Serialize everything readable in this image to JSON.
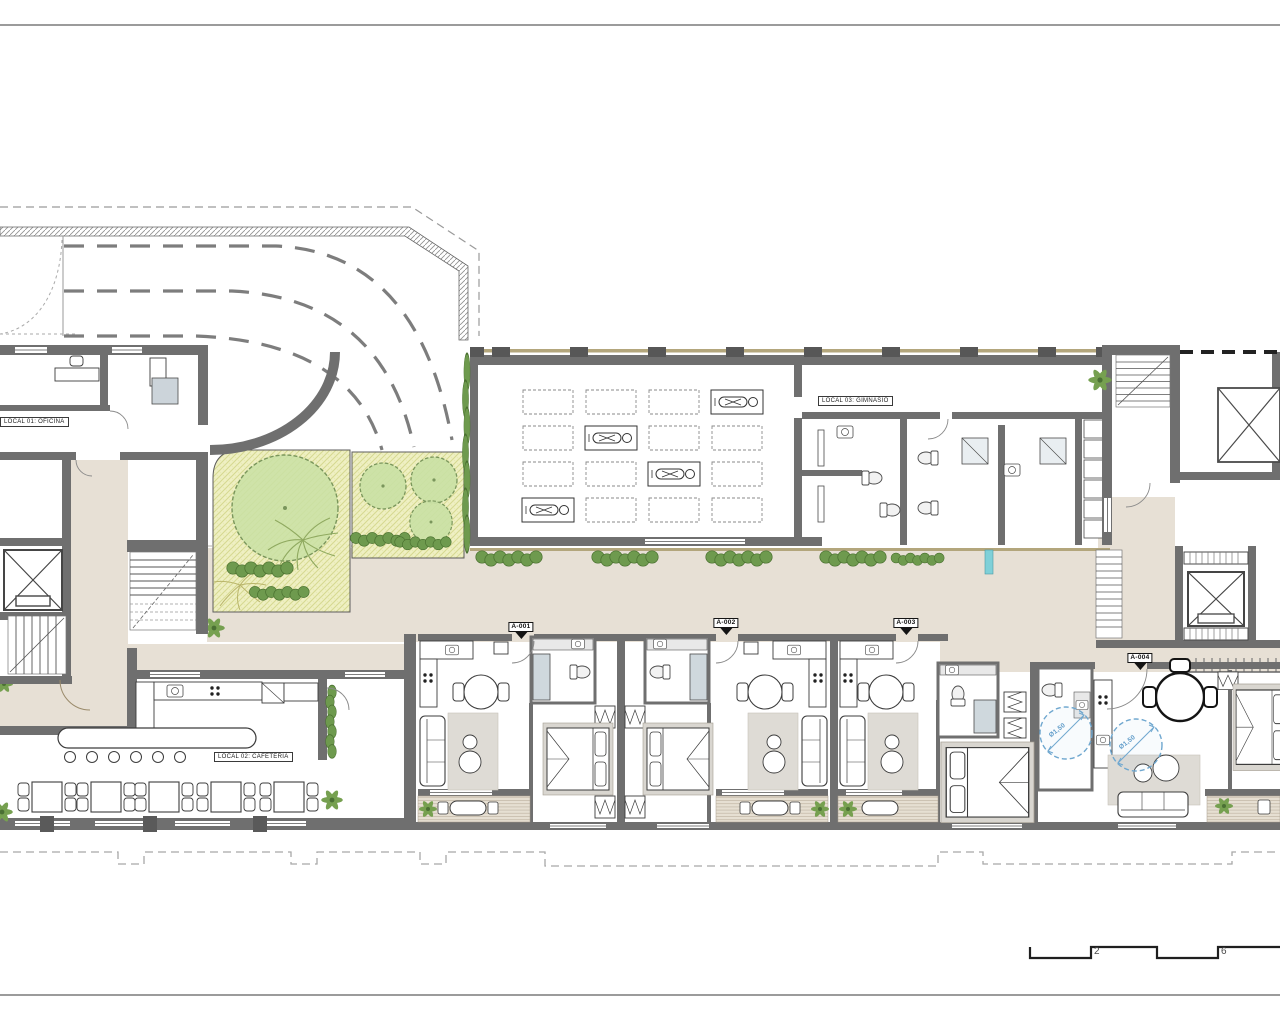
{
  "plan": {
    "locals": {
      "local_01": "LOCAL 01: OFICINA",
      "local_02": "LOCAL 02: CAFETERIA",
      "local_03": "LOCAL 03: GIMNASIO"
    },
    "units": [
      {
        "id": "A-001"
      },
      {
        "id": "A-002"
      },
      {
        "id": "A-003"
      },
      {
        "id": "A-004"
      }
    ],
    "accessibility": {
      "turning_circles": [
        "Ø1,50",
        "Ø1,50"
      ]
    },
    "scale_bar": {
      "ticks": [
        "2",
        "6"
      ]
    }
  },
  "colors": {
    "wall": "#6f6f6f",
    "corridor": "#e7e0d5",
    "garden": "#eff0c3",
    "tree": "#c9e0a4",
    "shrub": "#6e9a4e",
    "accent_blue": "#5e9bc9",
    "wood": "#b3a67c"
  }
}
